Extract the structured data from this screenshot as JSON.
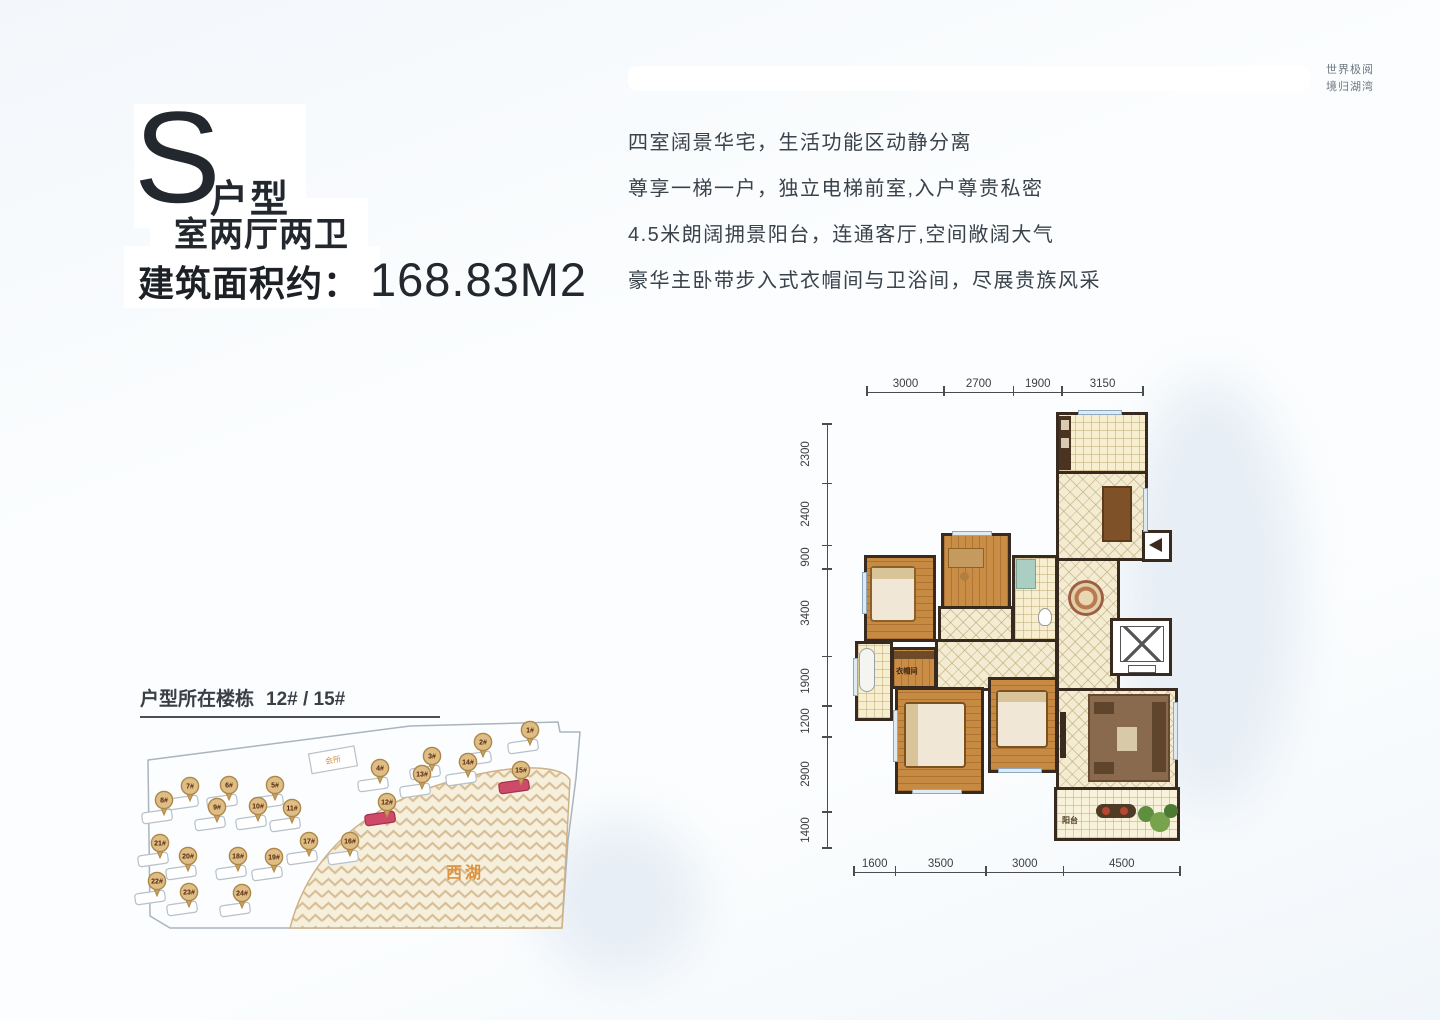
{
  "header": {
    "letter": "S",
    "letter_suffix": "户型",
    "subtitle": "室两厅两卫",
    "area_label": "建筑面积约：",
    "area_value": "168.83M2"
  },
  "tagline": {
    "line1": "世界极阅",
    "line2": "境归湖湾"
  },
  "description": {
    "lines": [
      "四室阔景华宅，生活功能区动静分离",
      "尊享一梯一户，独立电梯前室,入户尊贵私密",
      "4.5米朗阔拥景阳台，连通客厅,空间敞阔大气",
      "豪华主卧带步入式衣帽间与卫浴间，尽展贵族风采"
    ]
  },
  "site_map": {
    "title": "户型所在楼栋",
    "buildings": "12# / 15#",
    "lake_label": "西湖",
    "club_label": "会所",
    "highlight": [
      "12#",
      "15#"
    ],
    "pins": [
      {
        "label": "1#",
        "x": 390,
        "y": 10
      },
      {
        "label": "2#",
        "x": 343,
        "y": 22
      },
      {
        "label": "3#",
        "x": 292,
        "y": 36
      },
      {
        "label": "4#",
        "x": 240,
        "y": 48
      },
      {
        "label": "5#",
        "x": 135,
        "y": 65
      },
      {
        "label": "6#",
        "x": 89,
        "y": 65
      },
      {
        "label": "7#",
        "x": 50,
        "y": 66
      },
      {
        "label": "8#",
        "x": 24,
        "y": 80
      },
      {
        "label": "9#",
        "x": 77,
        "y": 87
      },
      {
        "label": "10#",
        "x": 118,
        "y": 86
      },
      {
        "label": "11#",
        "x": 152,
        "y": 88
      },
      {
        "label": "12#",
        "x": 247,
        "y": 82
      },
      {
        "label": "13#",
        "x": 282,
        "y": 54
      },
      {
        "label": "14#",
        "x": 328,
        "y": 42
      },
      {
        "label": "15#",
        "x": 381,
        "y": 50
      },
      {
        "label": "16#",
        "x": 210,
        "y": 121
      },
      {
        "label": "17#",
        "x": 169,
        "y": 121
      },
      {
        "label": "18#",
        "x": 98,
        "y": 136
      },
      {
        "label": "19#",
        "x": 134,
        "y": 137
      },
      {
        "label": "20#",
        "x": 48,
        "y": 136
      },
      {
        "label": "21#",
        "x": 20,
        "y": 123
      },
      {
        "label": "22#",
        "x": 17,
        "y": 161
      },
      {
        "label": "23#",
        "x": 49,
        "y": 172
      },
      {
        "label": "24#",
        "x": 102,
        "y": 173
      }
    ]
  },
  "floor_plan": {
    "dims_top": [
      "3000",
      "2700",
      "1900",
      "3150"
    ],
    "dims_left": [
      "2300",
      "2400",
      "900",
      "3400",
      "1900",
      "1200",
      "2900",
      "1400"
    ],
    "dims_bottom": [
      "1600",
      "3500",
      "3000",
      "4500"
    ],
    "labels": {
      "closet": "衣帽间",
      "balcony": "阳台"
    }
  }
}
